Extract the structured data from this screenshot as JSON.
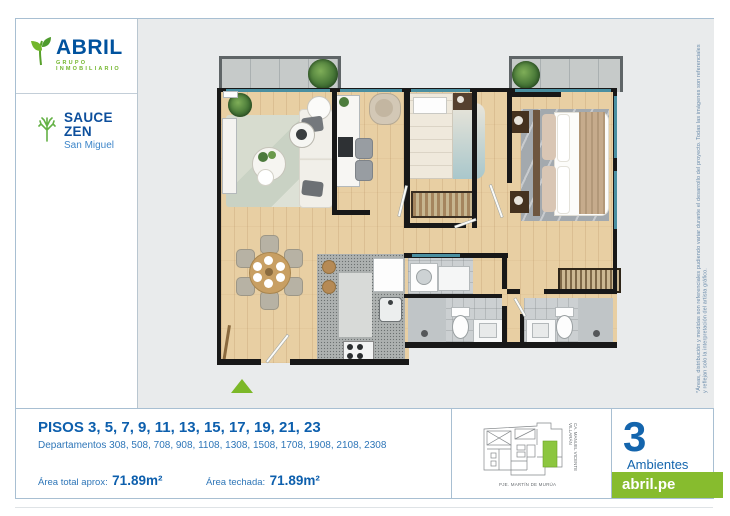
{
  "brand": {
    "name": "ABRIL",
    "tagline": "GRUPO INMOBILIARIO"
  },
  "project": {
    "name": "SAUCE ZEN",
    "district": "San Miguel"
  },
  "unit_info": {
    "floors_title": "PISOS 3, 5, 7, 9, 11, 13, 15, 17, 19, 21, 23",
    "departments": "Departamentos 308, 508, 708, 908, 1108, 1308, 1508, 1708, 1908, 2108, 2308",
    "area_total_label": "Área total aprox:",
    "area_total_value": "71.89m²",
    "area_roofed_label": "Área techada:",
    "area_roofed_value": "71.89m²"
  },
  "ambientes": {
    "count": "3",
    "label": "Ambientes"
  },
  "website": "abril.pe",
  "disclaimer": "*Áreas, distribución y medidas son referenciales pudiendo variar durante el desarrollo del proyecto. Todas las imágenes son referenciales y reflejan solo la interpretación del artista gráfico.",
  "keyplan": {
    "street_bottom": "PJE. MARTÍN DE MURÚA",
    "street_right": "CA. MANUEL VICENTE VILLARÁN"
  },
  "colors": {
    "brand_blue": "#0d5fad",
    "brand_green": "#87bc2e",
    "window_teal": "#4a8fa1",
    "wood_floor": "#e8cfa3"
  }
}
